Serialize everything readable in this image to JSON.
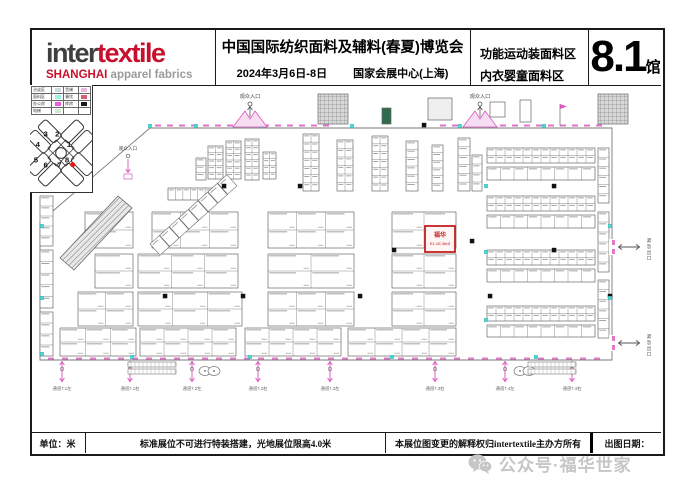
{
  "header": {
    "logo": {
      "inter": "inter",
      "textile": "textile",
      "shanghai": "SHANGHAI",
      "tagline": "apparel fabrics"
    },
    "title": "中国国际纺织面料及辅料(春夏)博览会",
    "date": "2024年3月6日-8日",
    "venue": "国家会展中心(上海)",
    "zone_line1": "功能运动装面料区",
    "zone_line2": "内衣婴童面料区",
    "hall_number": "8.1",
    "hall_suffix": "馆"
  },
  "legend": {
    "rows": [
      [
        {
          "t": "洽谈区"
        },
        {
          "s": "#cfd8dc"
        },
        {
          "t": "货梯"
        },
        {
          "s": "#e9b7e3"
        }
      ],
      [
        {
          "t": "面料区"
        },
        {
          "s": "#9ef2e6"
        },
        {
          "t": "餐饮"
        },
        {
          "s": "#e05a6e"
        }
      ],
      [
        {
          "t": "办公房"
        },
        {
          "s": "#ee5ce0"
        },
        {
          "t": "库房"
        },
        {
          "s": "#1a1a1a"
        }
      ],
      [
        {
          "t": "电梯"
        },
        {
          "s": "#cde9cd"
        },
        {
          "t": ""
        },
        {
          "s": ""
        }
      ]
    ]
  },
  "minimap": {
    "halls": [
      {
        "n": "3",
        "x": 13,
        "y": 21
      },
      {
        "n": "2",
        "x": 25,
        "y": 21
      },
      {
        "n": "4",
        "x": 5,
        "y": 32
      },
      {
        "n": "1",
        "x": 37,
        "y": 32
      },
      {
        "n": "5",
        "x": 3,
        "y": 48
      },
      {
        "n": "6",
        "x": 13,
        "y": 53
      },
      {
        "n": "7",
        "x": 27,
        "y": 53
      },
      {
        "n": "8",
        "x": 35,
        "y": 48
      }
    ],
    "dot": {
      "x": 43,
      "y": 50,
      "color": "#e01818"
    }
  },
  "plan": {
    "labels": {
      "entrance": "观众入口",
      "exit": "紧急出口",
      "passages": [
        "通道7.1左",
        "通道7.1右",
        "通道7.2左",
        "通道7.2右",
        "通道7.3左",
        "通道7.3右",
        "通道7.4左",
        "通道7.4右"
      ]
    },
    "highlight": {
      "name": "福华",
      "booth": "E1-08 36㎡",
      "x": 425,
      "y": 226,
      "w": 30,
      "h": 26,
      "color": "#c42020"
    },
    "colors": {
      "pink": "#d85abe",
      "cyan": "#4fd9cf",
      "wall": "#787878",
      "booth": "#6a6a6a",
      "label": "#555555"
    },
    "geometry": {
      "boundary": "M150,128 H612 V360 H40 V222 Z",
      "blocks": [
        [
          196,
          158,
          10,
          22,
          3,
          1
        ],
        [
          208,
          146,
          15,
          33,
          5,
          2
        ],
        [
          226,
          141,
          15,
          38,
          6,
          2
        ],
        [
          245,
          139,
          14,
          41,
          6,
          2
        ],
        [
          263,
          152,
          13,
          27,
          4,
          2
        ],
        [
          168,
          188,
          52,
          12,
          1,
          7
        ],
        [
          303,
          134,
          16,
          57,
          7,
          2
        ],
        [
          337,
          140,
          16,
          51,
          6,
          2
        ],
        [
          372,
          136,
          16,
          55,
          7,
          2
        ],
        [
          406,
          141,
          12,
          50,
          6,
          1
        ],
        [
          432,
          145,
          11,
          46,
          6,
          1
        ],
        [
          458,
          138,
          12,
          53,
          6,
          1
        ],
        [
          472,
          155,
          10,
          36,
          4,
          1
        ],
        [
          487,
          148,
          108,
          15,
          2,
          12
        ],
        [
          487,
          167,
          108,
          13,
          1,
          8
        ],
        [
          487,
          196,
          108,
          15,
          2,
          12
        ],
        [
          487,
          215,
          108,
          13,
          1,
          8
        ],
        [
          487,
          250,
          108,
          15,
          2,
          12
        ],
        [
          487,
          269,
          108,
          13,
          1,
          8
        ],
        [
          487,
          306,
          108,
          15,
          2,
          12
        ],
        [
          487,
          325,
          108,
          12,
          1,
          8
        ],
        [
          598,
          148,
          11,
          55,
          6,
          1
        ],
        [
          598,
          212,
          11,
          60,
          6,
          1
        ],
        [
          598,
          280,
          11,
          58,
          6,
          1
        ],
        [
          85,
          212,
          48,
          36,
          2,
          1
        ],
        [
          152,
          212,
          86,
          36,
          2,
          3
        ],
        [
          268,
          212,
          86,
          36,
          2,
          3
        ],
        [
          392,
          212,
          64,
          36,
          2,
          2
        ],
        [
          95,
          254,
          38,
          34,
          2,
          1
        ],
        [
          138,
          254,
          100,
          34,
          2,
          3
        ],
        [
          268,
          254,
          86,
          34,
          2,
          2
        ],
        [
          392,
          254,
          64,
          34,
          2,
          2
        ],
        [
          78,
          292,
          55,
          34,
          2,
          2
        ],
        [
          138,
          292,
          104,
          34,
          2,
          3
        ],
        [
          268,
          292,
          86,
          34,
          2,
          3
        ],
        [
          392,
          292,
          64,
          34,
          2,
          2
        ],
        [
          60,
          328,
          76,
          28,
          2,
          3
        ],
        [
          140,
          328,
          96,
          28,
          2,
          4
        ],
        [
          245,
          328,
          96,
          28,
          2,
          4
        ],
        [
          348,
          328,
          108,
          28,
          2,
          4
        ],
        [
          40,
          196,
          13,
          50,
          5,
          1
        ],
        [
          40,
          250,
          13,
          58,
          5,
          1
        ],
        [
          40,
          312,
          13,
          44,
          4,
          1
        ]
      ],
      "diag_strip": {
        "x": 150,
        "y": 244,
        "angle": -42,
        "cells": 8,
        "cw": 12.5,
        "ch": 15
      },
      "escalator": "60,258 118,196 132,208 74,270",
      "facilities": [
        {
          "x": 318,
          "y": 94,
          "w": 30,
          "h": 30,
          "f": "grid"
        },
        {
          "x": 598,
          "y": 94,
          "w": 30,
          "h": 30,
          "f": "grid"
        },
        {
          "x": 428,
          "y": 98,
          "w": 24,
          "h": 22,
          "f": "lite"
        },
        {
          "x": 382,
          "y": 108,
          "w": 9,
          "h": 16,
          "f": "dark"
        },
        {
          "x": 490,
          "y": 102,
          "w": 15,
          "h": 15,
          "f": "line"
        },
        {
          "x": 520,
          "y": 100,
          "w": 11,
          "h": 22,
          "f": "line"
        }
      ],
      "pillars": [
        [
          224,
          186
        ],
        [
          165,
          296
        ],
        [
          243,
          296
        ],
        [
          394,
          250
        ],
        [
          472,
          241
        ],
        [
          554,
          186
        ],
        [
          490,
          296
        ],
        [
          610,
          296
        ],
        [
          424,
          125
        ],
        [
          300,
          186
        ],
        [
          360,
          296
        ],
        [
          554,
          250
        ]
      ],
      "cyans": [
        [
          150,
          126
        ],
        [
          196,
          126
        ],
        [
          262,
          126
        ],
        [
          352,
          126
        ],
        [
          460,
          126
        ],
        [
          544,
          126
        ],
        [
          42,
          226
        ],
        [
          42,
          298
        ],
        [
          42,
          354
        ],
        [
          132,
          357
        ],
        [
          250,
          357
        ],
        [
          392,
          357
        ],
        [
          536,
          357
        ],
        [
          610,
          226
        ],
        [
          610,
          298
        ],
        [
          486,
          186
        ],
        [
          486,
          252
        ],
        [
          486,
          320
        ]
      ],
      "top_dashes": [
        [
          155,
          335
        ],
        [
          440,
          598
        ]
      ],
      "bottom_dashes": [
        [
          48,
          606
        ]
      ],
      "entrances_top": [
        250,
        480
      ],
      "entrance_left": {
        "x": 128,
        "y": 150
      },
      "exits_right": [
        247,
        343
      ],
      "passage_xs": [
        62,
        130,
        192,
        258,
        330,
        435,
        505,
        572
      ],
      "toilets": [
        205,
        520
      ],
      "ladders": [
        128,
        528
      ],
      "flags": [
        [
          560,
          104
        ]
      ]
    }
  },
  "footer": {
    "cells": [
      "单位：米",
      "标准展位不可进行特装搭建，光地展位限高4.0米",
      "本展位图变更的解释权归intertextile主办方所有",
      "出图日期："
    ]
  },
  "watermark": {
    "icon": "wechat-icon",
    "text": "公众号·福华世家"
  }
}
